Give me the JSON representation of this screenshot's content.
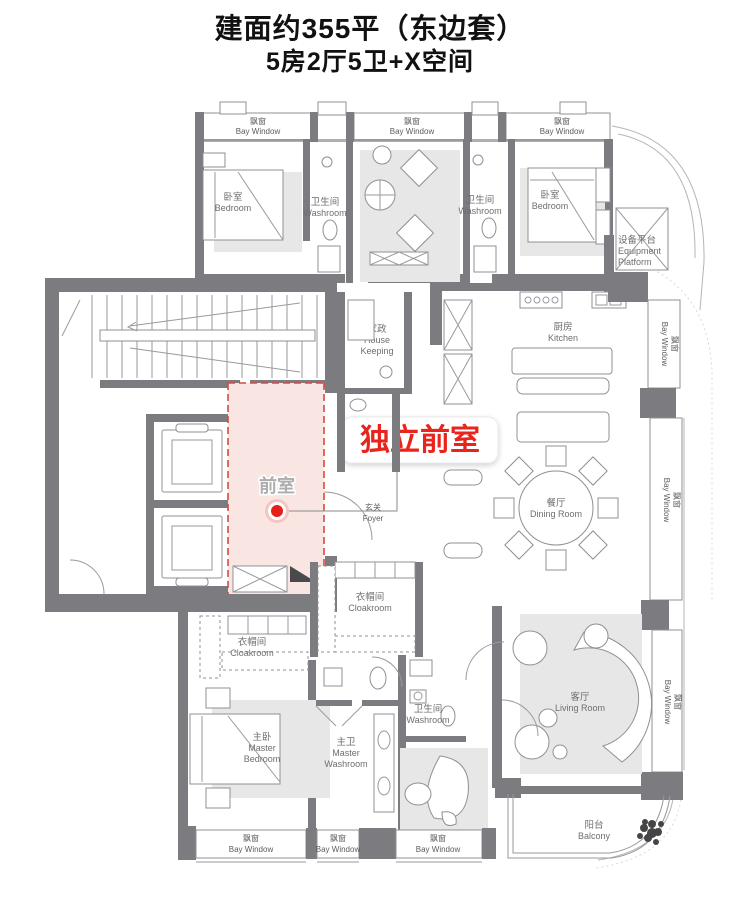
{
  "header": {
    "title": "建面约355平（东边套）",
    "subtitle": "5房2厅5卫+X空间"
  },
  "highlight": {
    "callout": "独立前室",
    "room": "前室"
  },
  "labels": {
    "bay_zh": "飘窗",
    "bay_en": "Bay Window",
    "bedroom_zh": "卧室",
    "bedroom_en": "Bedroom",
    "washroom_zh": "卫生间",
    "washroom_en": "Washroom",
    "equipment_zh": "设备平台",
    "equipment_en1": "Equipment",
    "equipment_en2": "Platform",
    "housekeeping_zh": "家政",
    "housekeeping_en1": "House",
    "housekeeping_en2": "Keeping",
    "kitchen_zh": "厨房",
    "kitchen_en": "Kitchen",
    "foyer_zh": "玄关",
    "foyer_en": "Foyer",
    "dining_zh": "餐厅",
    "dining_en": "Dining Room",
    "cloakroom_zh": "衣帽间",
    "cloakroom_en": "Cloakroom",
    "master_bedroom_zh": "主卧",
    "master_bedroom_en1": "Master",
    "master_bedroom_en2": "Bedroom",
    "master_washroom_zh": "主卫",
    "master_washroom_en1": "Master",
    "master_washroom_en2": "Washroom",
    "living_zh": "客厅",
    "living_en": "Living Room",
    "balcony_zh": "阳台",
    "balcony_en": "Balcony"
  },
  "colors": {
    "wall": "#7b7b80",
    "highlight_fill": "#f9e6e3",
    "highlight_border": "#d84a42",
    "callout_red": "#e8241d"
  }
}
